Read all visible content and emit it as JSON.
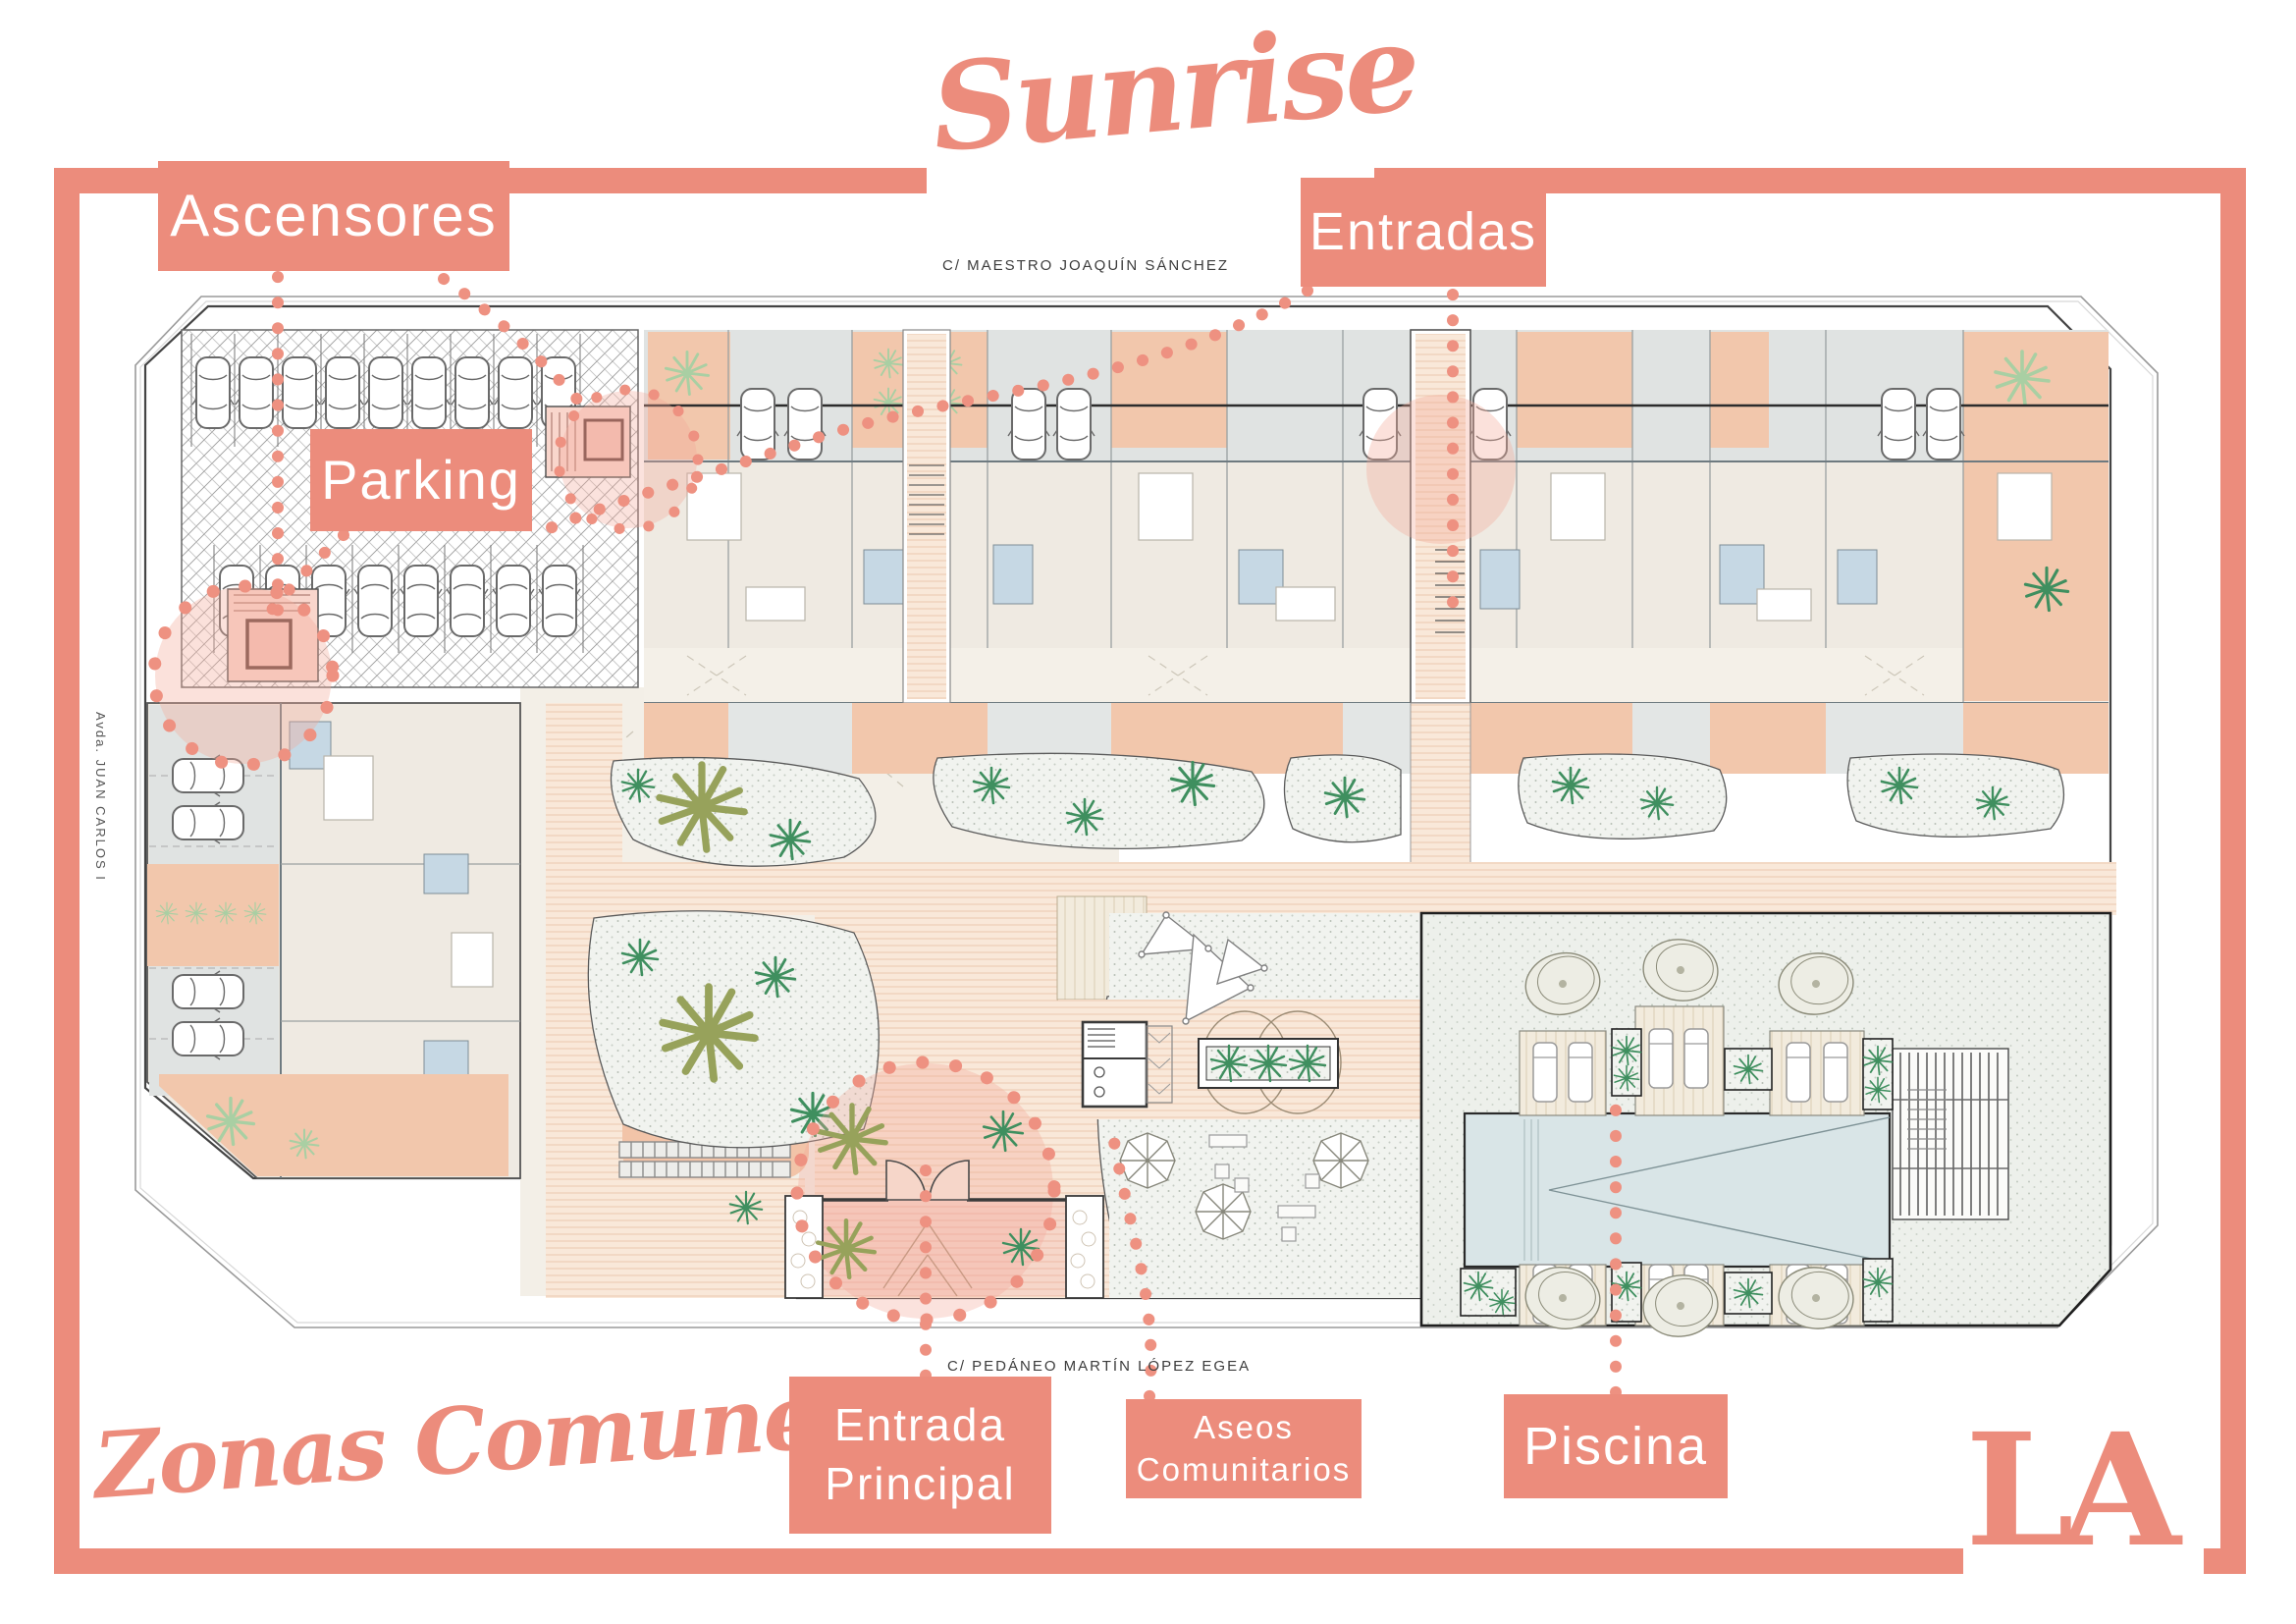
{
  "branding": {
    "project_name": "Sunrise",
    "plan_title": "Zonas Comunes",
    "logo": "LA"
  },
  "colors": {
    "accent": "#EC8C7C",
    "leader_dots": "#EF9383",
    "highlight_fill": "rgba(243,168,153,0.35)",
    "patio_salmon": "#F2C7AC",
    "path_peach": "#F9E8D9",
    "roof_grey": "#E0E3E2",
    "room_beige": "#EFEAE2",
    "bath_blue": "#C6D8E4",
    "garden_green": "#3F8F5F",
    "olive_green": "#97A25B",
    "light_green": "#A9CFA3",
    "pool_blue": "#D9E5E7"
  },
  "annotations": {
    "ascensores": {
      "label": "Ascensores"
    },
    "parking": {
      "label": "Parking"
    },
    "entradas": {
      "label": "Entradas"
    },
    "entrada_principal": {
      "line1": "Entrada",
      "line2": "Principal"
    },
    "aseos_comunitarios": {
      "line1": "Aseos",
      "line2": "Comunitarios"
    },
    "piscina": {
      "label": "Piscina"
    }
  },
  "streets": {
    "north": "C/ MAESTRO JOAQUÍN SÁNCHEZ",
    "south": "C/ PEDÁNEO MARTÍN LÓPEZ EGEA",
    "west": "Avda. JUAN CARLOS I"
  }
}
